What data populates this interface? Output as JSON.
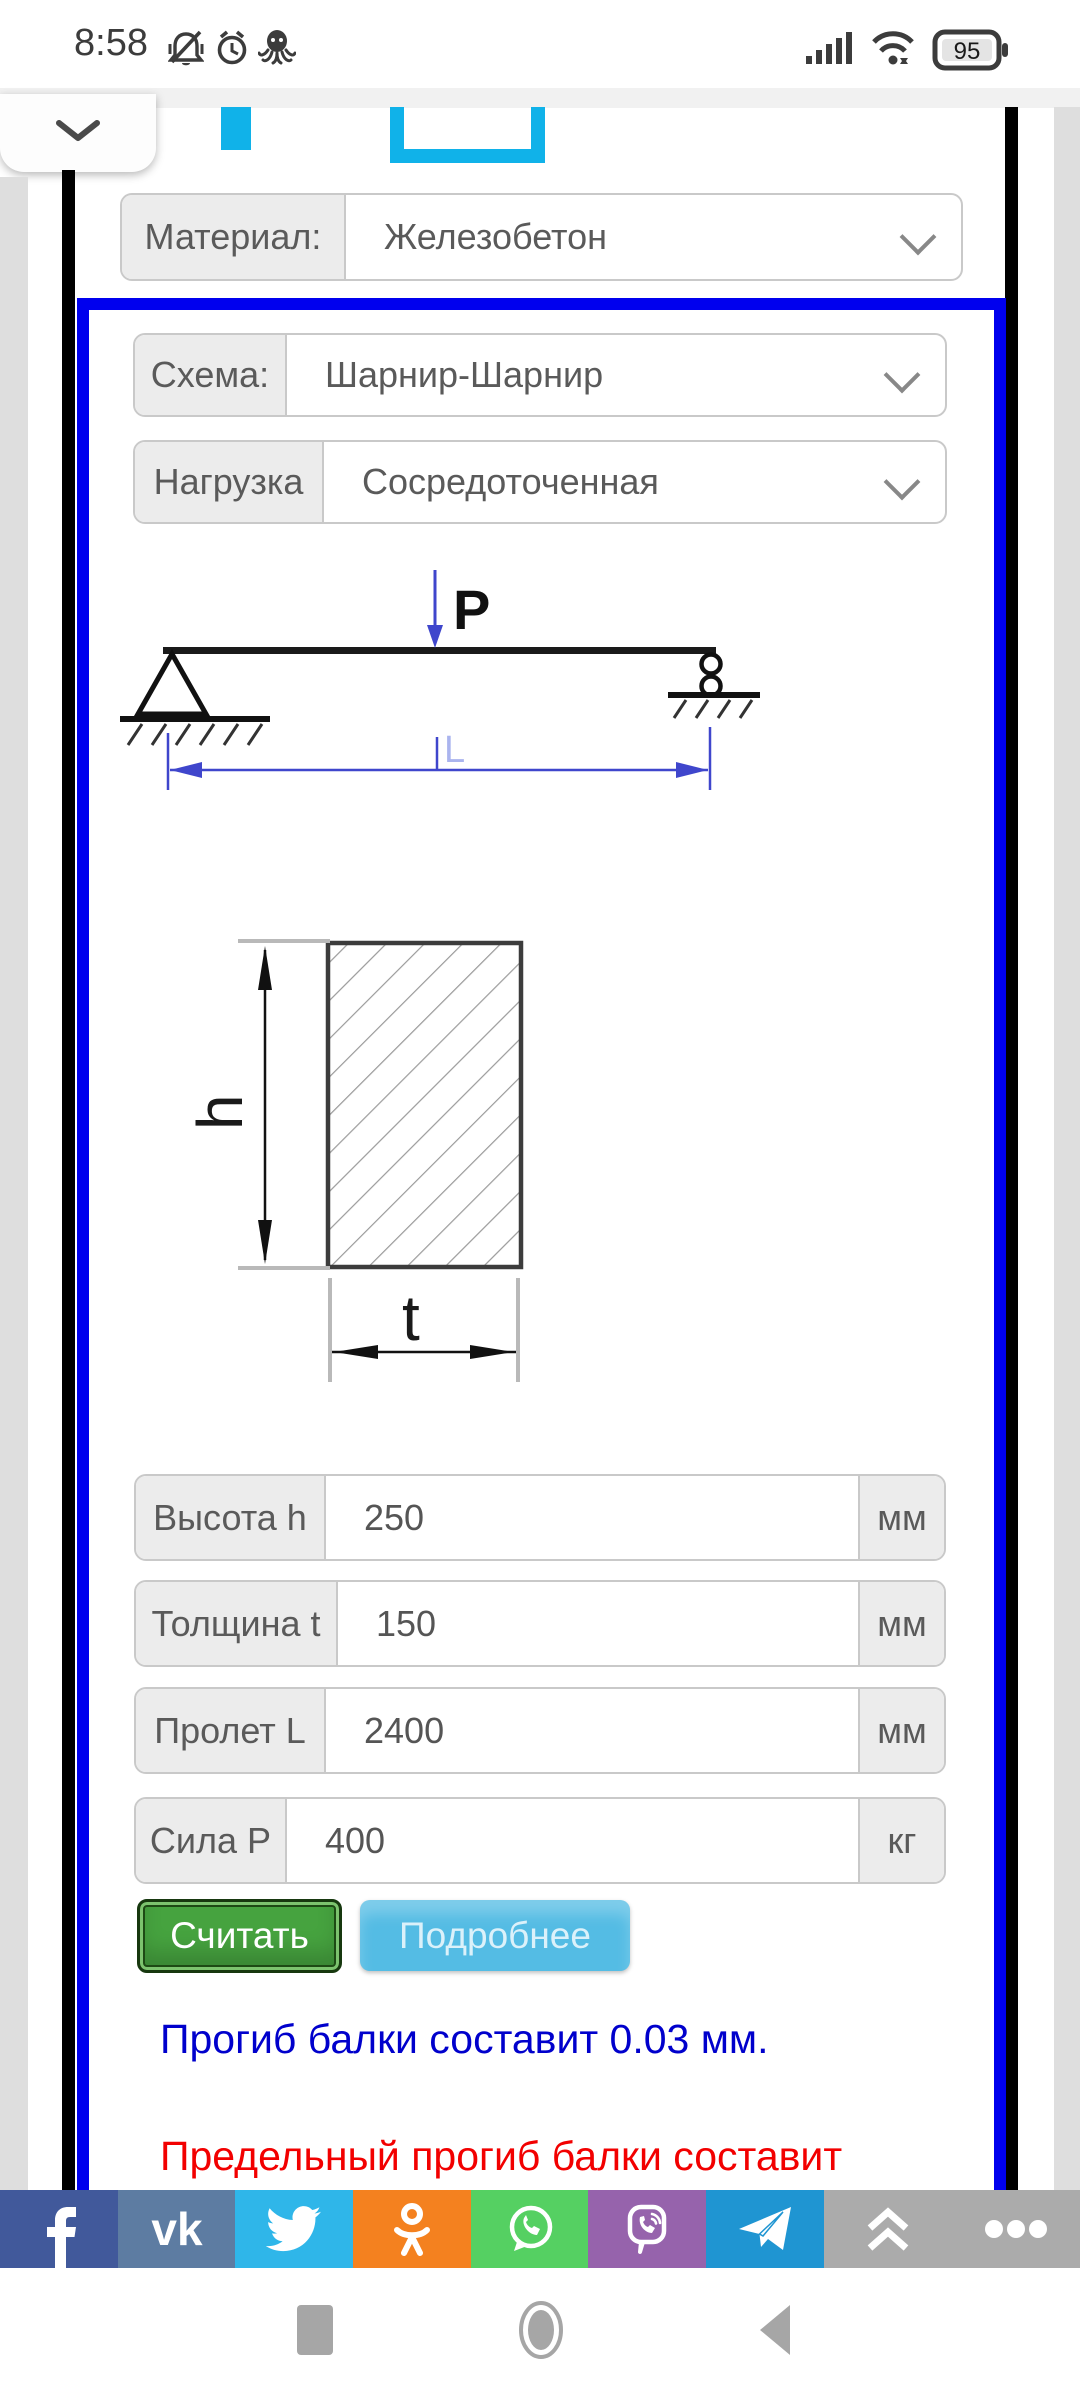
{
  "status_bar": {
    "time": "8:58",
    "battery_level": "95",
    "left_icons": [
      "vibrate-muted",
      "alarm",
      "octopus-app"
    ],
    "right_icons": [
      "signal",
      "wifi",
      "battery"
    ]
  },
  "form": {
    "material_label": "Материал:",
    "material_value": "Железобетон",
    "scheme_label": "Схема:",
    "scheme_value": "Шарнир-Шарнир",
    "load_label": "Нагрузка",
    "load_value": "Сосредоточенная",
    "diagram": {
      "force_label": "P",
      "span_label": "L",
      "height_label": "h",
      "thickness_label": "t"
    },
    "fields": [
      {
        "label": "Высота h",
        "value": "250",
        "unit": "мм"
      },
      {
        "label": "Толщина t",
        "value": "150",
        "unit": "мм"
      },
      {
        "label": "Пролет L",
        "value": "2400",
        "unit": "мм"
      },
      {
        "label": "Сила P",
        "value": "400",
        "unit": "кг"
      }
    ],
    "calc_button": "Считать",
    "details_button": "Подробнее",
    "result_deflection": "Прогиб балки составит 0.03 мм.",
    "result_limit": "Предельный прогиб балки составит"
  },
  "colors": {
    "box_border": "#0000ee",
    "result_blue": "#0000cc",
    "result_red": "#f20000",
    "calc_green": "#46a33f",
    "details_blue": "#54bce4",
    "facebook": "#41599b",
    "vk": "#5d7ca2",
    "twitter": "#2fb6e9",
    "odnoklassniki": "#f4811f",
    "whatsapp": "#55d062",
    "viber": "#9663ac",
    "telegram": "#1f95d2",
    "share_more_bg": "#ababab"
  },
  "share_bar": {
    "items": [
      "facebook",
      "vk",
      "twitter",
      "odnoklassniki",
      "whatsapp",
      "viber",
      "telegram",
      "collapse",
      "more"
    ],
    "vk_text": "vk"
  }
}
